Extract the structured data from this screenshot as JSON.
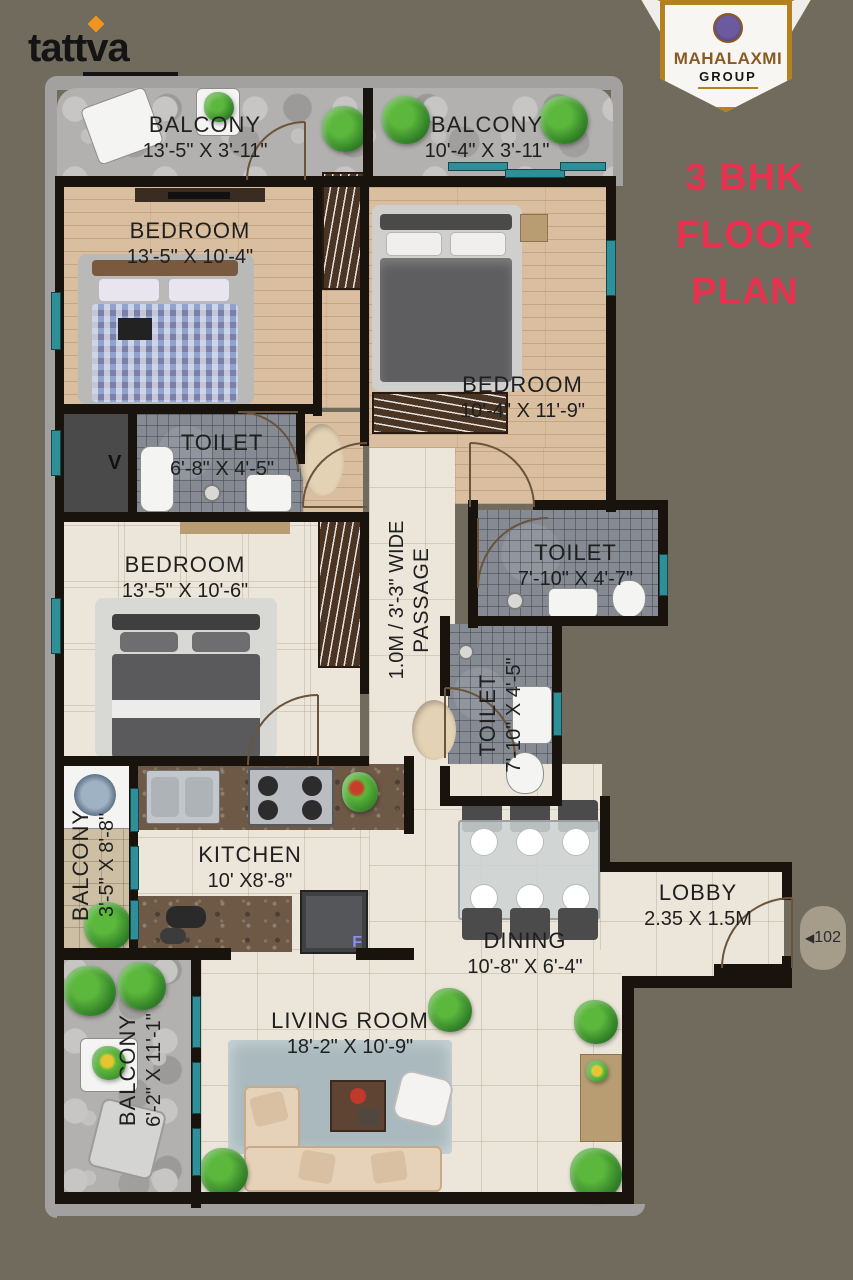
{
  "page": {
    "background": "#716b5d"
  },
  "logo": {
    "text": "tattva"
  },
  "badge": {
    "title": "MAHALAXMI",
    "subtitle": "GROUP"
  },
  "plan_title": {
    "line1": "3 BHK",
    "line2": "FLOOR",
    "line3": "PLAN",
    "color": "#e8304f"
  },
  "rooms": {
    "balcony_tl": {
      "name": "BALCONY",
      "dims": "13'-5\" X 3'-11\""
    },
    "balcony_tr": {
      "name": "BALCONY",
      "dims": "10'-4\" X 3'-11\""
    },
    "bedroom1": {
      "name": "BEDROOM",
      "dims": "13'-5\" X 10'-4\""
    },
    "bedroom2": {
      "name": "BEDROOM",
      "dims": "10'-4\" X 11'-9\""
    },
    "toilet1": {
      "name": "TOILET",
      "dims": "6'-8\" X 4'-5\""
    },
    "bedroom3": {
      "name": "BEDROOM",
      "dims": "13'-5\" X 10'-6\""
    },
    "passage": {
      "name": "PASSAGE",
      "dims": "1.0M / 3'-3\" WIDE"
    },
    "toilet2": {
      "name": "TOILET",
      "dims": "7'-10\" X 4'-7\""
    },
    "toilet3": {
      "name": "TOILET",
      "dims": "7'-10\" X 4'-5\""
    },
    "balcony_left": {
      "name": "BALCONY",
      "dims": "3'-5\" X 8'-8\""
    },
    "kitchen": {
      "name": "KITCHEN",
      "dims": "10' X8'-8\""
    },
    "dining": {
      "name": "DINING",
      "dims": "10'-8\" X 6'-4\""
    },
    "lobby": {
      "name": "LOBBY",
      "dims": "2.35 X 1.5M"
    },
    "balcony_bottom": {
      "name": "BALCONY",
      "dims": "6'-2\" X 11'-1\""
    },
    "living": {
      "name": "LIVING ROOM",
      "dims": "18'-2\" X 10'-9\""
    }
  },
  "markers": {
    "unit_number": "102",
    "unit_arrow": "◀",
    "fridge": "F",
    "vent": "V"
  }
}
